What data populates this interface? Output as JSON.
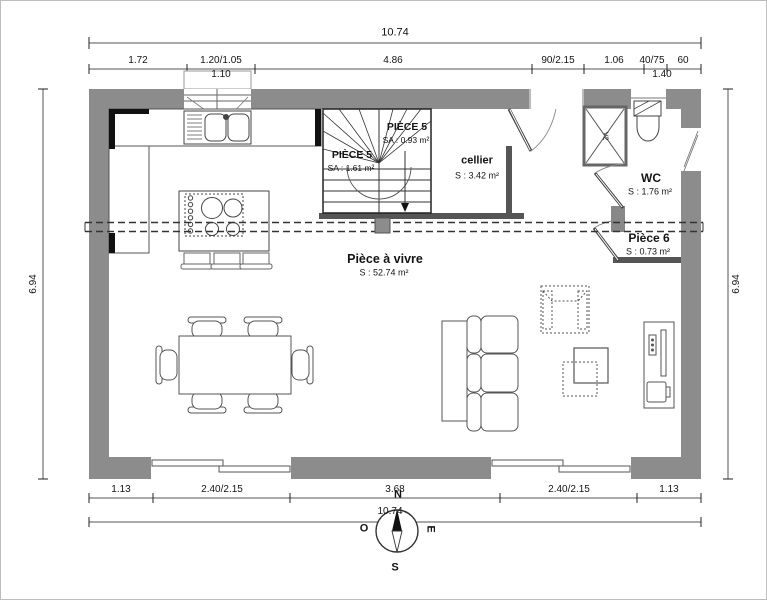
{
  "plan": {
    "dims_top": {
      "total": "10.74",
      "segments": [
        "1.72",
        "1.20/1.05",
        "4.86",
        "90/2.15",
        "1.06",
        "40/75",
        "60"
      ],
      "sub_window": "1.10",
      "sub_door": "1.40"
    },
    "dims_bottom": {
      "segments": [
        "1.13",
        "2.40/2.15",
        "3.68",
        "2.40/2.15",
        "1.13"
      ],
      "total": "10.74"
    },
    "dims_left": "6.94",
    "dims_right": "6.94",
    "rooms": {
      "piece5_upper": {
        "name": "PIÈCE 5",
        "area": "SA : 0.93 m²"
      },
      "piece5_lower": {
        "name": "PIÈCE 5",
        "area": "SA : 1.61 m²"
      },
      "cellier": {
        "name": "cellier",
        "area": "S : 3.42 m²"
      },
      "wc": {
        "name": "WC",
        "area": "S : 1.76 m²"
      },
      "piece6": {
        "name": "Pièce 6",
        "area": "S : 0.73 m²"
      },
      "piece_a_vivre": {
        "name": "Pièce à vivre",
        "area": "S : 52.74 m²"
      }
    },
    "annotations": {
      "shaft": "V2"
    },
    "compass": {
      "north": "N",
      "south": "S",
      "east": "E",
      "west": "O"
    },
    "colors": {
      "wall": "#8c8c8c",
      "line": "#222222"
    }
  }
}
